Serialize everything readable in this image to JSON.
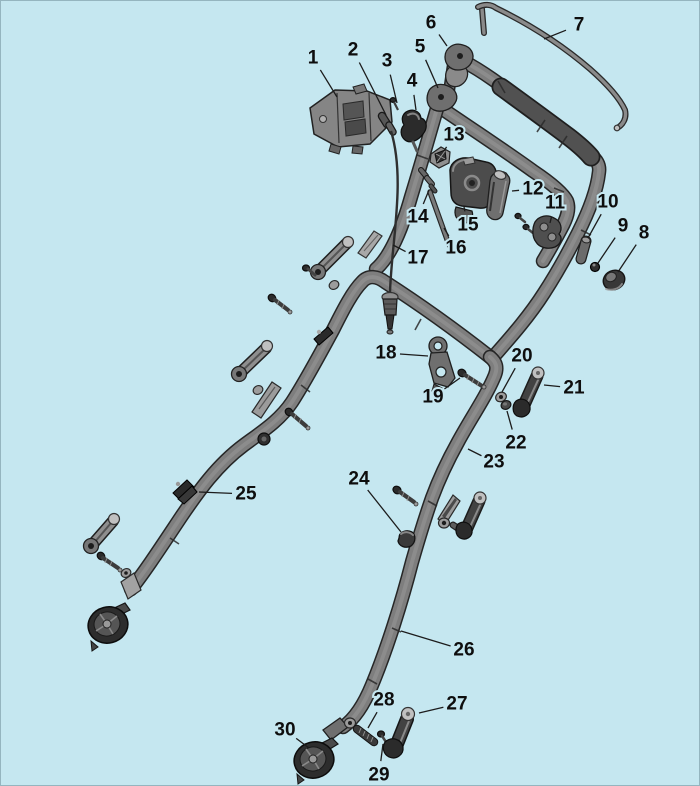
{
  "canvas": {
    "width": 700,
    "height": 786,
    "background": "#c5e7f0",
    "border_color": "#5a7882"
  },
  "palette": {
    "tube": "#7e7e7e",
    "tube_outline": "#262626",
    "grip": "#515151",
    "part_dark": "#3a3a3a",
    "part_mid": "#6f6f6f",
    "part_light": "#9c9c9c",
    "part_bright": "#c0c0c0",
    "label_color": "#0e0e0e",
    "leader_color": "#1c1c1c"
  },
  "diagram": {
    "type": "exploded-parts-diagram",
    "label_font_size": 19,
    "callouts": [
      {
        "n": "1",
        "x": 312,
        "y": 57,
        "tx": 336,
        "ty": 96
      },
      {
        "n": "2",
        "x": 352,
        "y": 49,
        "tx": 385,
        "ty": 114
      },
      {
        "n": "3",
        "x": 386,
        "y": 60,
        "tx": 396,
        "ty": 102
      },
      {
        "n": "4",
        "x": 411,
        "y": 80,
        "tx": 415,
        "ty": 109
      },
      {
        "n": "5",
        "x": 419,
        "y": 46,
        "tx": 437,
        "ty": 87
      },
      {
        "n": "6",
        "x": 430,
        "y": 22,
        "tx": 446,
        "ty": 45
      },
      {
        "n": "7",
        "x": 578,
        "y": 24,
        "tx": 543,
        "ty": 38
      },
      {
        "n": "8",
        "x": 643,
        "y": 232,
        "tx": 617,
        "ty": 271
      },
      {
        "n": "9",
        "x": 622,
        "y": 225,
        "tx": 597,
        "ty": 262
      },
      {
        "n": "10",
        "x": 607,
        "y": 201,
        "tx": 587,
        "ty": 237
      },
      {
        "n": "11",
        "x": 554,
        "y": 202,
        "tx": 549,
        "ty": 222
      },
      {
        "n": "12",
        "x": 532,
        "y": 188,
        "tx": 511,
        "ty": 190
      },
      {
        "n": "13",
        "x": 453,
        "y": 134,
        "tx": 443,
        "ty": 150
      },
      {
        "n": "14",
        "x": 417,
        "y": 216,
        "tx": 428,
        "ty": 189
      },
      {
        "n": "15",
        "x": 467,
        "y": 224,
        "tx": 463,
        "ty": 206
      },
      {
        "n": "16",
        "x": 455,
        "y": 247,
        "tx": 443,
        "ty": 227
      },
      {
        "n": "17",
        "x": 417,
        "y": 257,
        "tx": 392,
        "ty": 244
      },
      {
        "n": "18",
        "x": 385,
        "y": 352,
        "tx": 427,
        "ty": 355
      },
      {
        "n": "19",
        "x": 432,
        "y": 396,
        "tx": 459,
        "ty": 377
      },
      {
        "n": "20",
        "x": 521,
        "y": 355,
        "tx": 501,
        "ty": 391
      },
      {
        "n": "21",
        "x": 573,
        "y": 387,
        "tx": 543,
        "ty": 384
      },
      {
        "n": "22",
        "x": 515,
        "y": 442,
        "tx": 506,
        "ty": 410
      },
      {
        "n": "23",
        "x": 493,
        "y": 461,
        "tx": 467,
        "ty": 448
      },
      {
        "n": "24",
        "x": 358,
        "y": 478,
        "tx": 400,
        "ty": 531
      },
      {
        "n": "25",
        "x": 245,
        "y": 493,
        "tx": 198,
        "ty": 491
      },
      {
        "n": "26",
        "x": 463,
        "y": 649,
        "tx": 400,
        "ty": 630
      },
      {
        "n": "27",
        "x": 456,
        "y": 703,
        "tx": 418,
        "ty": 712
      },
      {
        "n": "28",
        "x": 383,
        "y": 699,
        "tx": 367,
        "ty": 727
      },
      {
        "n": "29",
        "x": 378,
        "y": 774,
        "tx": 382,
        "ty": 743
      },
      {
        "n": "30",
        "x": 284,
        "y": 729,
        "tx": 308,
        "ty": 747
      }
    ]
  }
}
